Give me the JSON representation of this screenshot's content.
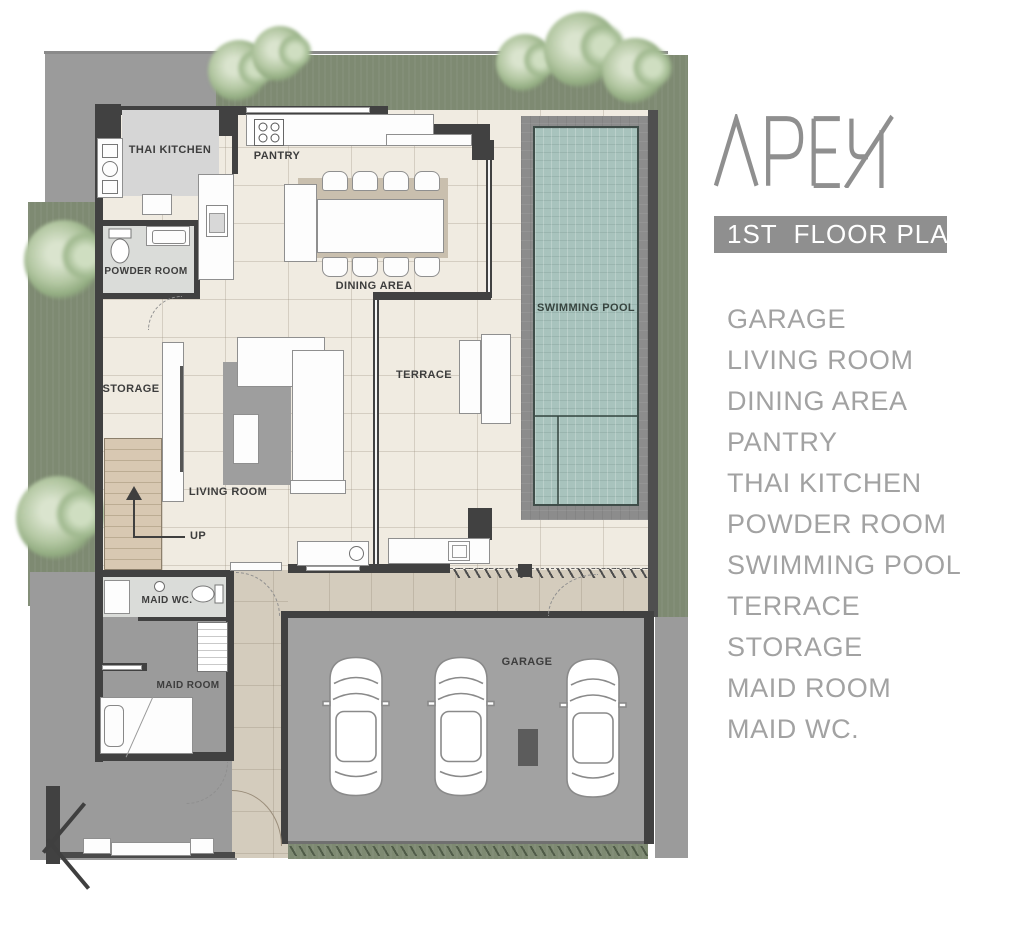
{
  "brand": {
    "name": "APEX",
    "logo_color": "#8f8f8f"
  },
  "header": {
    "badge_label": "1ST  FLOOR PLAN",
    "badge_bg": "#8f8f8f",
    "badge_text_color": "#ffffff"
  },
  "legend": {
    "text_color": "#a2a2a2",
    "items": [
      "GARAGE",
      "LIVING ROOM",
      "DINING AREA",
      "PANTRY",
      "THAI KITCHEN",
      "POWDER ROOM",
      "SWIMMING POOL",
      "TERRACE",
      "STORAGE",
      "MAID ROOM",
      "MAID WC."
    ]
  },
  "plan": {
    "labels": {
      "thai_kitchen": "THAI KITCHEN",
      "pantry": "PANTRY",
      "powder_room": "POWDER ROOM",
      "dining_area": "DINING AREA",
      "swimming_pool": "SWIMMING POOL",
      "terrace": "TERRACE",
      "storage": "STORAGE",
      "living_room": "LIVING ROOM",
      "up": "UP",
      "maid_wc": "MAID WC.",
      "maid_room": "MAID ROOM",
      "garage": "GARAGE"
    },
    "colors": {
      "grass": "#7e8a72",
      "tree": "#b3c7a2",
      "paving": "#9b9b9b",
      "wall": "#414141",
      "floor": "#f0ebe1",
      "pool_water": "#a8c3bd",
      "pool_deck": "#8c8c8c",
      "driveway": "#d4ccbd",
      "garage_floor": "#a2a2a2",
      "stairs": "#d8c8b2",
      "rug": "#9e9e9e"
    }
  }
}
